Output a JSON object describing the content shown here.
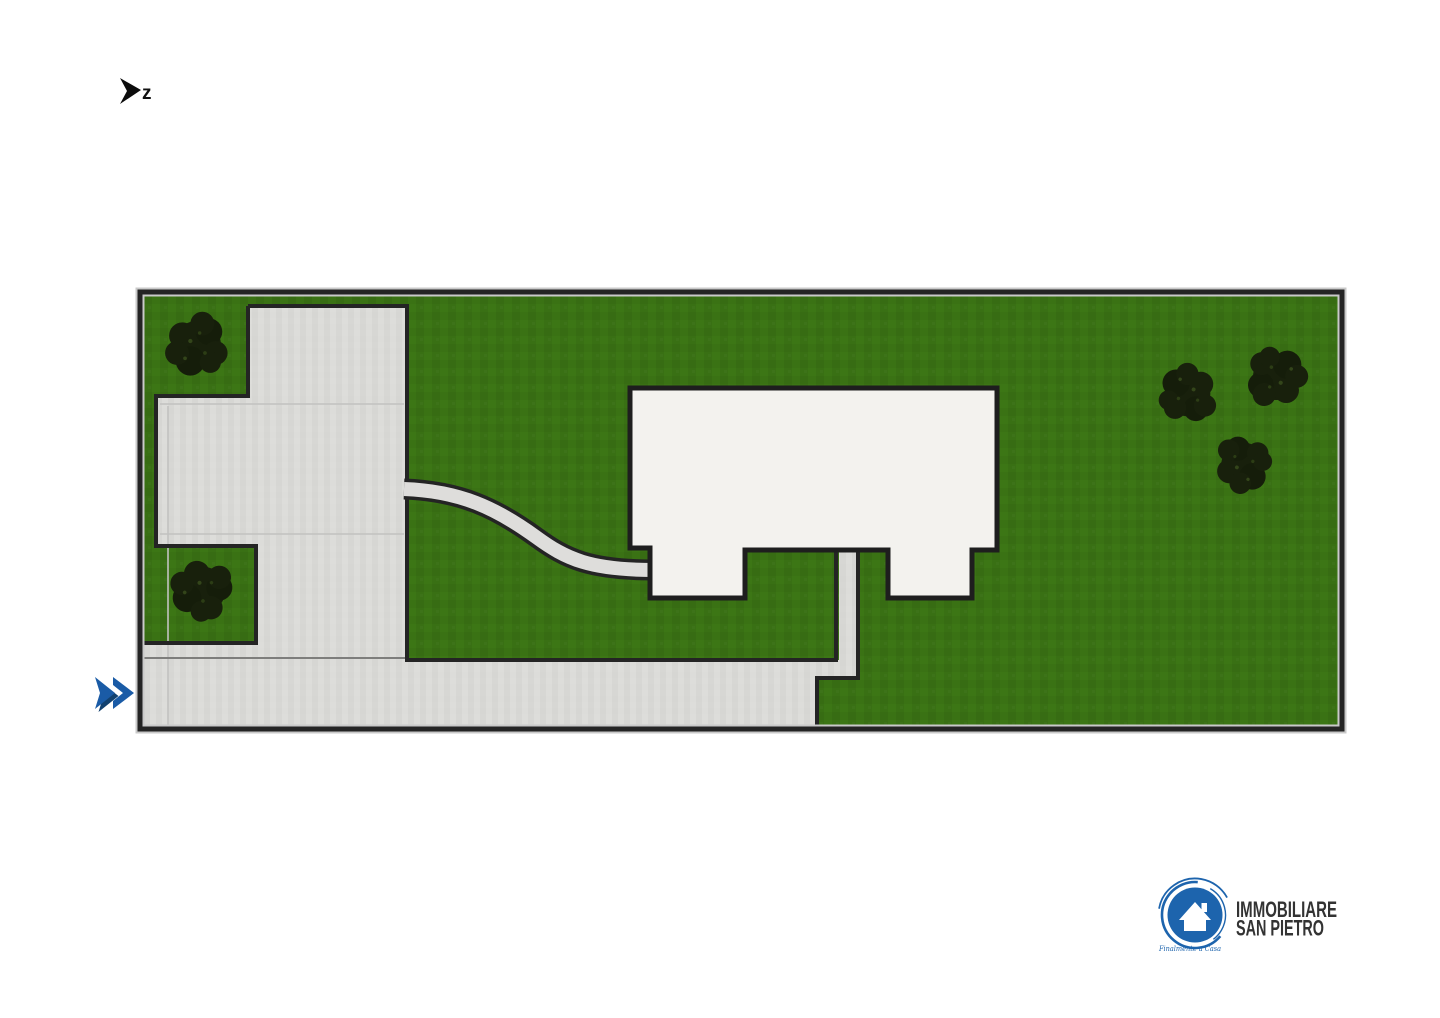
{
  "page": {
    "background": "#ffffff",
    "description_label": "site plan"
  },
  "north_indicator": {
    "label": "z",
    "color": "#0c0c0c"
  },
  "nav": {
    "chevron_color": "#1a5ba6",
    "chevron_shadow": "#12416f"
  },
  "site_plan": {
    "lawn_color": "#3c7615",
    "lawn_shade": "#356a12",
    "paving_color": "#dcdcd9",
    "paving_seam_color": "#c2c2c0",
    "building_color": "#f3f2ee",
    "outline_color": "#242424",
    "tree_color": "#18200c",
    "tree_count": "5"
  },
  "logo": {
    "line1": "IMMOBILIARE",
    "line2": "SAN PIETRO",
    "tagline": "Finalmente a Casa",
    "brand_color": "#1d64ad",
    "text_color": "#333333"
  }
}
